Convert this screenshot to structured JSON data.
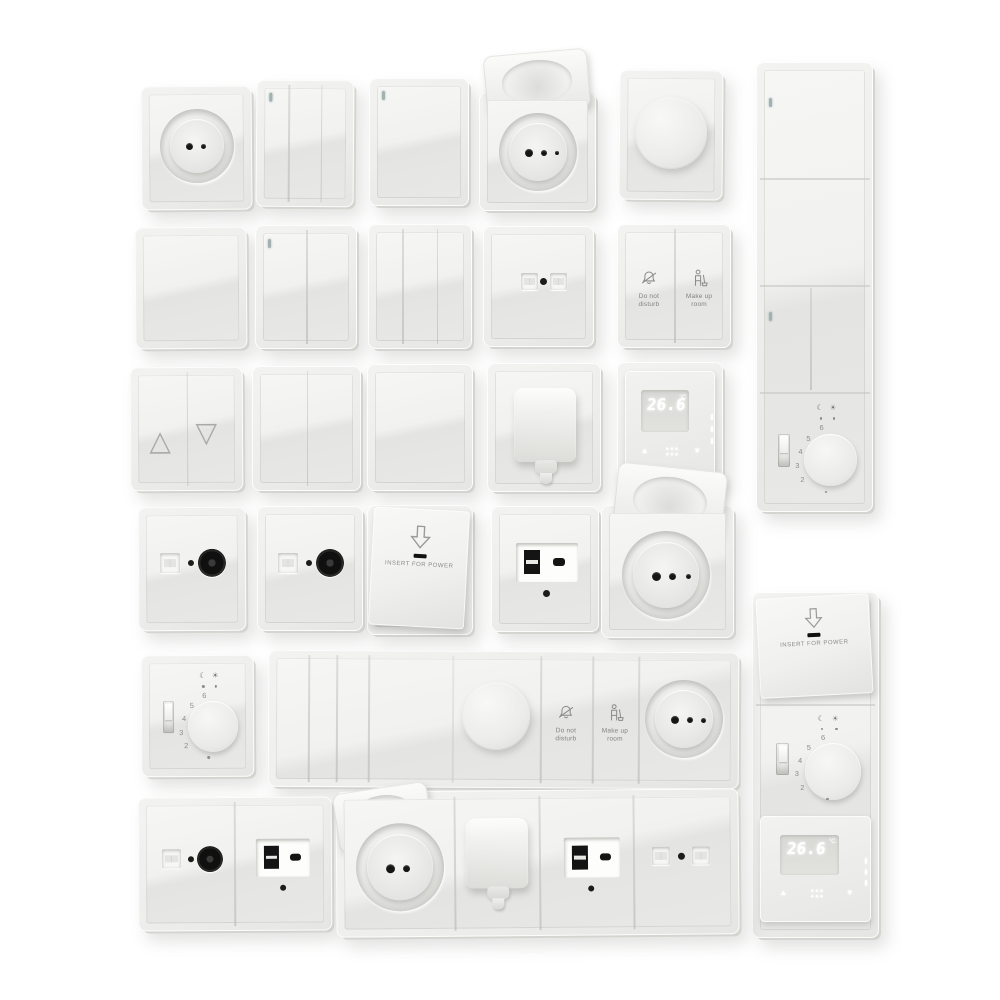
{
  "colors": {
    "background": "#ffffff",
    "plate": "#ececea",
    "face_highlight": "#f6f6f4",
    "face_shadow": "#e4e4e2",
    "edge_shadow": "#d4d4d0",
    "port_black": "#141414",
    "icon_stroke": "#8a8a86",
    "led_indicator": "#a3b1b3",
    "display_glow": "#ffffff"
  },
  "labels": {
    "dnd_line1": "Do not",
    "dnd_line2": "disturb",
    "mur_line1": "Make up",
    "mur_line2": "room",
    "insert_for_power": "INSERT FOR POWER",
    "temp_value": "26.6",
    "temp_unit": "°C",
    "arrow_up": "▲",
    "arrow_down": "▼",
    "blind_up": "△",
    "blind_down": "▽",
    "moon_symbol": "☾",
    "sun_symbol": "☀"
  },
  "dial": {
    "numbers": [
      "6",
      "5",
      "4",
      "3",
      "2"
    ]
  }
}
